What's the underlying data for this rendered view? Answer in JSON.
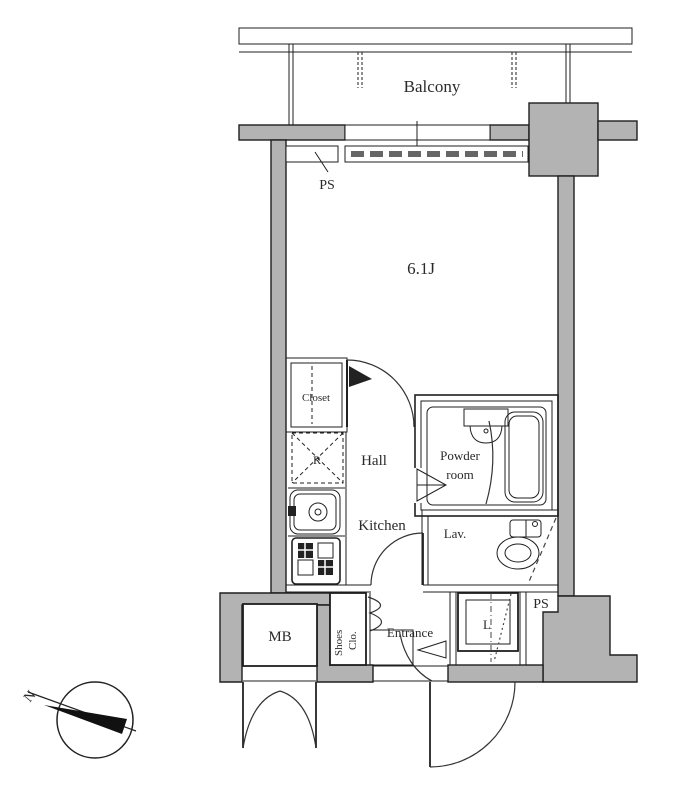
{
  "plan": {
    "type": "apartment-floor-plan",
    "labels": {
      "balcony": "Balcony",
      "ps_top": "PS",
      "room_size": "6.1J",
      "closet": "Closet",
      "fridge": "R",
      "hall": "Hall",
      "kitchen": "Kitchen",
      "powder_line1": "Powder",
      "powder_line2": "room",
      "lav": "Lav.",
      "ps_bottom": "PS",
      "mb": "MB",
      "shoes_line1": "Shoes",
      "shoes_line2": "Clo.",
      "entrance": "Entrance",
      "laundry": "L",
      "compass_north": "N"
    },
    "colors": {
      "wall_fill": "#b3b3b3",
      "line": "#1f1f1f",
      "background": "#ffffff"
    }
  }
}
